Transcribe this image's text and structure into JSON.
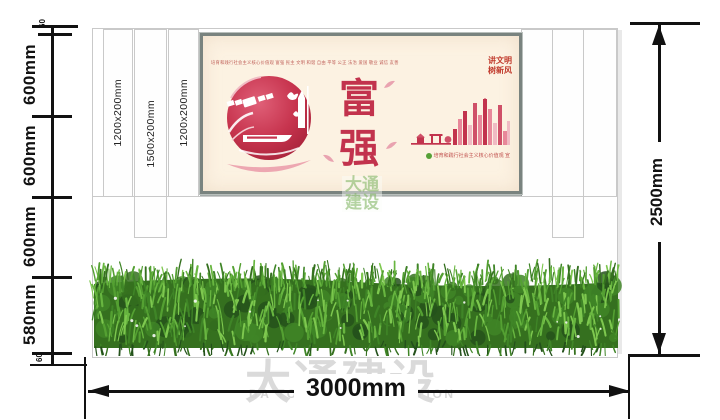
{
  "dimensions": {
    "left_segments": [
      {
        "label": "60"
      },
      {
        "label": "600mm"
      },
      {
        "label": "600mm"
      },
      {
        "label": "600mm"
      },
      {
        "label": "580mm"
      },
      {
        "label": "60"
      }
    ],
    "right_label": "2500mm",
    "bottom_label": "3000mm"
  },
  "panel_strips": {
    "labels": [
      "1200x200mm",
      "1500x200mm",
      "1200x200mm"
    ]
  },
  "poster": {
    "values_line": "培育和践行社会主义核心价值观  富强 民主 文明 和谐 自由 平等 公正 法治 爱国 敬业 诚信 友善",
    "slogan_line1": "讲文明",
    "slogan_line2": "树新风",
    "char_top": "富",
    "char_bottom": "强",
    "credit": "培育和践行社会主义核心价值观 宣"
  },
  "watermarks": {
    "center_line1": "大通",
    "center_line2": "建设",
    "bottom_cn": "大通建设",
    "bottom_en": "DA TONG CONSTRUCTION"
  },
  "colors": {
    "accent_red": "#c2334d",
    "poster_bg": "#fcf2e2",
    "poster_frame": "#79837f",
    "wall_line": "#c9c9c9",
    "dim_black": "#111111",
    "watermark_gray": "#dadada",
    "watermark_green": "rgba(120,175,88,0.55)",
    "credit_green": "#56a036",
    "hedge_palette": [
      "#24511b",
      "#35701f",
      "#3f8527",
      "#54a032",
      "#68b640",
      "#7ec84f"
    ]
  }
}
